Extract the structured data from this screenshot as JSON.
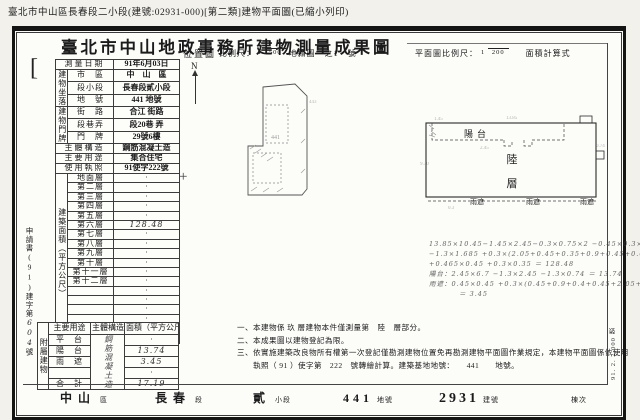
{
  "header": {
    "top_note": "臺北市中山區長春段二小段(建號:02931-000)[第二類]建物平面圖(已縮小列印)",
    "title": "臺北市中山地政事務所建物測量成果圖"
  },
  "survey_table": {
    "date_label": "測量日期",
    "date_value": "91年6月03日",
    "location_group": "建物坐落",
    "loc_rows": [
      {
        "label": "市　區",
        "value": "中　山　區"
      },
      {
        "label": "段小段",
        "value": "長春段貳小段"
      },
      {
        "label": "地　號",
        "value": "441 地號"
      }
    ],
    "door_group": "建物門牌",
    "door_rows": [
      {
        "label": "街　路",
        "value": "合江 街路"
      },
      {
        "label": "段巷弄",
        "value": "段20巷 弄"
      },
      {
        "label": "門　牌",
        "value": "29號6樓"
      }
    ],
    "structure_label": "主體構造",
    "structure_value": "鋼筋混凝土造",
    "use_label": "主要用途",
    "use_value": "集合住宅",
    "license_label": "使用執照",
    "license_value": "91使字222號",
    "area_group": "建築面積（平方公尺）",
    "floor_rows": [
      {
        "label": "地面層",
        "value": "·"
      },
      {
        "label": "第二層",
        "value": "·"
      },
      {
        "label": "第三層",
        "value": "·"
      },
      {
        "label": "第四層",
        "value": "·"
      },
      {
        "label": "第五層",
        "value": "·"
      },
      {
        "label": "第六層",
        "value": "128.48"
      },
      {
        "label": "第七層",
        "value": "·"
      },
      {
        "label": "第八層",
        "value": "·"
      },
      {
        "label": "第九層",
        "value": "·"
      },
      {
        "label": "第十層",
        "value": "·"
      },
      {
        "label": "第十一層",
        "value": "·"
      },
      {
        "label": "第十二層",
        "value": "·"
      },
      {
        "label": "",
        "value": "·"
      },
      {
        "label": "",
        "value": "·"
      },
      {
        "label": "",
        "value": "·"
      },
      {
        "label": "",
        "value": "·"
      },
      {
        "label": "騎　樓",
        "value": "·"
      },
      {
        "label": "合　計",
        "value": "128.48"
      }
    ]
  },
  "applicant_margin": {
    "text": "申請書(91)建字第",
    "number": "604",
    "suffix": "號"
  },
  "annex_table": {
    "group": "附屬建物",
    "headers": [
      "主要用途",
      "主體構造",
      "面積（平方公尺）"
    ],
    "structure_value": "鋼筋混凝土造",
    "rows": [
      [
        "平　台",
        "·"
      ],
      [
        "陽　台",
        "13.74"
      ],
      [
        "雨　遮",
        "3.45"
      ],
      [
        "",
        "·"
      ],
      [
        "合　計",
        "17.19"
      ]
    ]
  },
  "location_map": {
    "label": "位置圖",
    "north": "N",
    "scale_label": "比例尺：",
    "scale_num": "1",
    "scale_den": "500",
    "scale_suffix": "地籍圖　之1　號",
    "annotations": [
      "441",
      "443"
    ]
  },
  "floor_plan": {
    "scale_label": "平面圖比例尺：",
    "scale_num": "1",
    "scale_den": "200",
    "formula_label": "面積計算式",
    "balcony_label": "陽台",
    "floor_char1": "陸",
    "floor_char2": "層",
    "canopy_label": "雨遮",
    "dims": [
      "13.85",
      "1.45",
      "2.45",
      "9.30",
      "0.74",
      "0.3"
    ],
    "calc_lines": [
      "13.85×10.45−1.45×2.45−0.3×0.75×2 −0.45×0.3×2.40",
      "−1.3×1.685 +0.3×(2.05+0.45+0.35+0.9+0.45+0.05)",
      "+0.465×0.45 +0.3×0.35 ＝ 128.48",
      "陽台：2.45×6.7 −1.3×2.45 −1.3×0.74 ＝ 13.74",
      "雨遮：0.45×0.45 +0.3×(0.45+0.9+0.4+0.45+2.05+0.3×0.90)",
      "＝ 3.45"
    ]
  },
  "notes": [
    "一、本建物係 玖 層建物本件僅測量第　陸　層部分。",
    "二、本成果圖以建物登記為限。",
    "三、依實施建築改良物所有權第一次登記僅勘測建物位置免再勘測建物平面圖作業規定，本建物平面圖係依使用",
    "　　執照（ 91 ）使字第　222　號轉繪計算。建築基地地號：　　441　　地號。"
  ],
  "footer": {
    "items": [
      {
        "value": "中山",
        "unit": "區"
      },
      {
        "value": "長春",
        "unit": "段"
      },
      {
        "value": "貳",
        "unit": "小段"
      },
      {
        "value": "441",
        "unit": "地號"
      },
      {
        "value": "2931",
        "unit": "建號"
      },
      {
        "value": "",
        "unit": "棟次"
      }
    ]
  },
  "side_stamp": "91. 2. 2,000 張"
}
